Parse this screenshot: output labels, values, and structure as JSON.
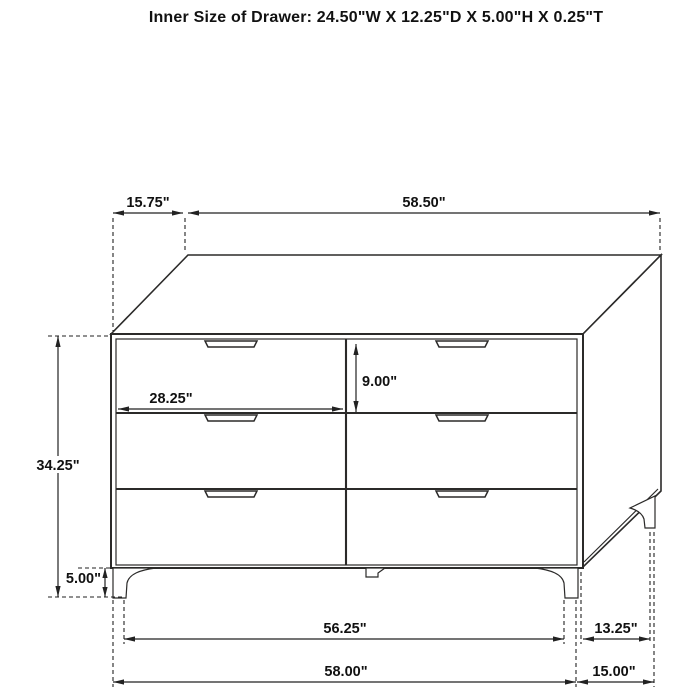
{
  "title": "Inner Size of Drawer: 24.50\"W X 12.25\"D X 5.00\"H X 0.25\"T",
  "dimensions": {
    "top_setback": "15.75\"",
    "top_width": "58.50\"",
    "drawer_width": "28.25\"",
    "drawer_height": "9.00\"",
    "overall_height": "34.25\"",
    "leg_height": "5.00\"",
    "front_leg_span": "56.25\"",
    "side_leg_span": "13.25\"",
    "overall_width": "58.00\"",
    "overall_depth": "15.00\""
  },
  "colors": {
    "line": "#2b2a29",
    "text": "#111111",
    "background": "#ffffff"
  }
}
